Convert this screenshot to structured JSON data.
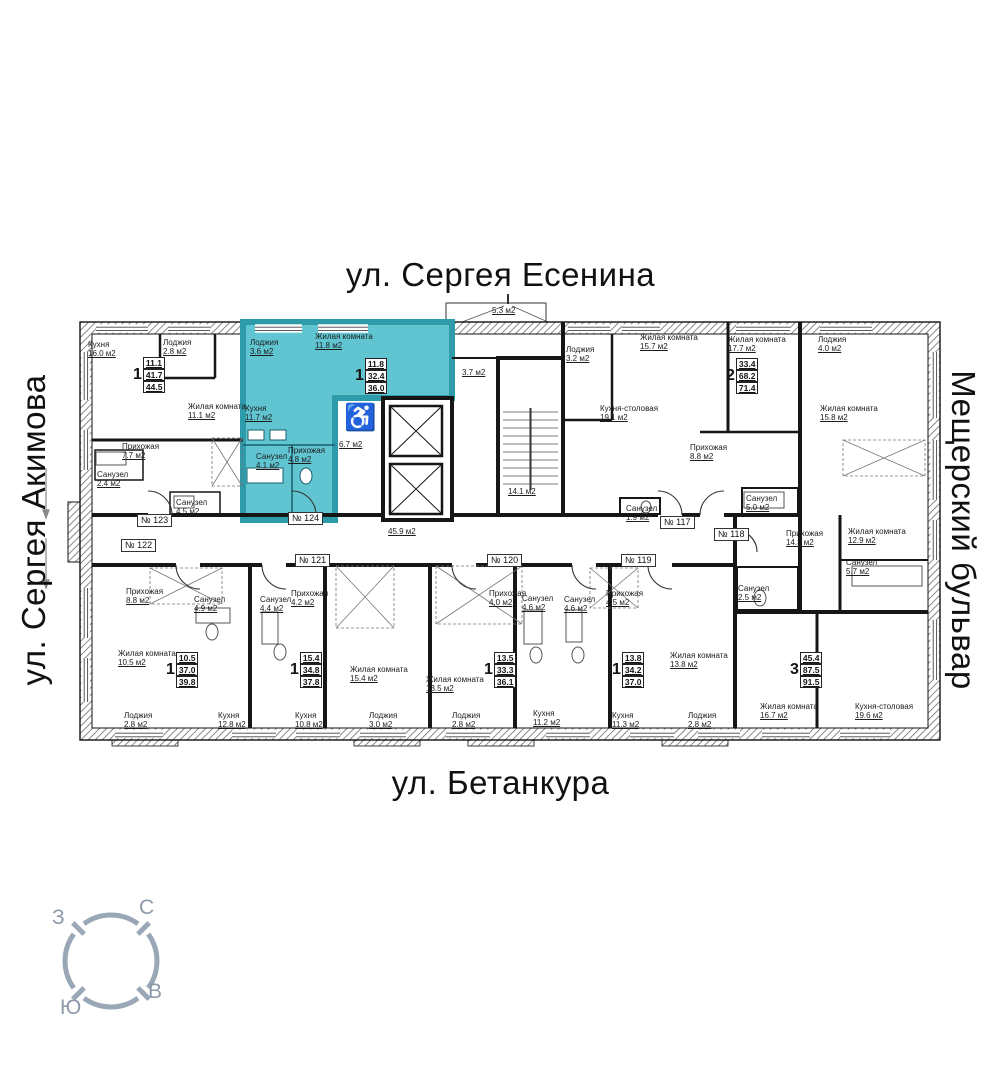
{
  "streets": {
    "top": "ул. Сергея Есенина",
    "bottom": "ул. Бетанкура",
    "left": "ул. Сергея Акимова",
    "right": "Мещерский бульвар"
  },
  "compass": {
    "west": "З",
    "north": "С",
    "east": "В",
    "south": "Ю"
  },
  "icons": {
    "wheelchair": "♿"
  },
  "colors": {
    "highlight": "#60c5d1",
    "highlight_wall": "#2d9ba9",
    "wheelchair_red": "#b3251d",
    "compass_gray": "#9aa7b6"
  },
  "numbers": [
    "№ 123",
    "№ 124",
    "№ 122",
    "№ 121",
    "№ 120",
    "№ 119",
    "№ 118",
    "№ 117"
  ],
  "stats": [
    {
      "n": "1",
      "a1": "11.1",
      "a2": "41.7",
      "a3": "44.5"
    },
    {
      "n": "1",
      "a1": "11.8",
      "a2": "32.4",
      "a3": "36.0"
    },
    {
      "n": "2",
      "a1": "33.4",
      "a2": "68.2",
      "a3": "71.4"
    },
    {
      "n": "3",
      "a1": "45.4",
      "a2": "87.5",
      "a3": "91.5"
    },
    {
      "n": "1",
      "a1": "10.5",
      "a2": "37.0",
      "a3": "39.8"
    },
    {
      "n": "1",
      "a1": "15.4",
      "a2": "34.8",
      "a3": "37.8"
    },
    {
      "n": "1",
      "a1": "13.5",
      "a2": "33.3",
      "a3": "36.1"
    },
    {
      "n": "1",
      "a1": "13.8",
      "a2": "34.2",
      "a3": "37.0"
    }
  ],
  "rooms": [
    {
      "name": "Кухня",
      "area": "16.0 м2"
    },
    {
      "name": "Лоджия",
      "area": "2.8 м2"
    },
    {
      "name": "Жилая комната",
      "area": "11.1 м2"
    },
    {
      "name": "Прихожая",
      "area": "7.7 м2"
    },
    {
      "name": "Санузел",
      "area": "2.4 м2"
    },
    {
      "name": "Санузел",
      "area": "4.5 м2"
    },
    {
      "name": "Лоджия",
      "area": "3.6 м2"
    },
    {
      "name": "Жилая комната",
      "area": "11.8 м2"
    },
    {
      "name": "Кухня",
      "area": "11.7 м2"
    },
    {
      "name": "Санузел",
      "area": "4.1 м2"
    },
    {
      "name": "Прихожая",
      "area": "4.8 м2"
    },
    {
      "name": "",
      "area": "6.7 м2"
    },
    {
      "name": "",
      "area": "3.7 м2"
    },
    {
      "name": "",
      "area": "5.3 м2"
    },
    {
      "name": "",
      "area": "14.1 м2"
    },
    {
      "name": "",
      "area": "45.9 м2"
    },
    {
      "name": "Лоджия",
      "area": "3.2 м2"
    },
    {
      "name": "Жилая комната",
      "area": "15.7 м2"
    },
    {
      "name": "Кухня-столовая",
      "area": "19.1 м2"
    },
    {
      "name": "Санузел",
      "area": "1.9 м2"
    },
    {
      "name": "Жилая комната",
      "area": "17.7 м2"
    },
    {
      "name": "Прихожая",
      "area": "8.8 м2"
    },
    {
      "name": "Санузел",
      "area": "5.0 м2"
    },
    {
      "name": "Лоджия",
      "area": "4.0 м2"
    },
    {
      "name": "Жилая комната",
      "area": "15.8 м2"
    },
    {
      "name": "Жилая комната",
      "area": "12.9 м2"
    },
    {
      "name": "Санузел",
      "area": "5.7 м2"
    },
    {
      "name": "Санузел",
      "area": "2.5 м2"
    },
    {
      "name": "Прихожая",
      "area": "14.3 м2"
    },
    {
      "name": "Жилая комната",
      "area": "16.7 м2"
    },
    {
      "name": "Кухня-столовая",
      "area": "19.6 м2"
    },
    {
      "name": "Прихожая",
      "area": "8.8 м2"
    },
    {
      "name": "Санузел",
      "area": "4.9 м2"
    },
    {
      "name": "Жилая комната",
      "area": "10.5 м2"
    },
    {
      "name": "Лоджия",
      "area": "2.8 м2"
    },
    {
      "name": "Кухня",
      "area": "12.8 м2"
    },
    {
      "name": "Санузел",
      "area": "4.4 м2"
    },
    {
      "name": "Прихожая",
      "area": "4.2 м2"
    },
    {
      "name": "Кухня",
      "area": "10.8 м2"
    },
    {
      "name": "Жилая комната",
      "area": "15.4 м2"
    },
    {
      "name": "Лоджия",
      "area": "3.0 м2"
    },
    {
      "name": "Прихожая",
      "area": "4.0 м2"
    },
    {
      "name": "Санузел",
      "area": "4.6 м2"
    },
    {
      "name": "Жилая комната",
      "area": "13.5 м2"
    },
    {
      "name": "Лоджия",
      "area": "2.8 м2"
    },
    {
      "name": "Кухня",
      "area": "11.2 м2"
    },
    {
      "name": "Санузел",
      "area": "4.6 м2"
    },
    {
      "name": "Прихожая",
      "area": "4.5 м2"
    },
    {
      "name": "Жилая комната",
      "area": "13.8 м2"
    },
    {
      "name": "Кухня",
      "area": "11.3 м2"
    },
    {
      "name": "Лоджия",
      "area": "2.8 м2"
    }
  ]
}
